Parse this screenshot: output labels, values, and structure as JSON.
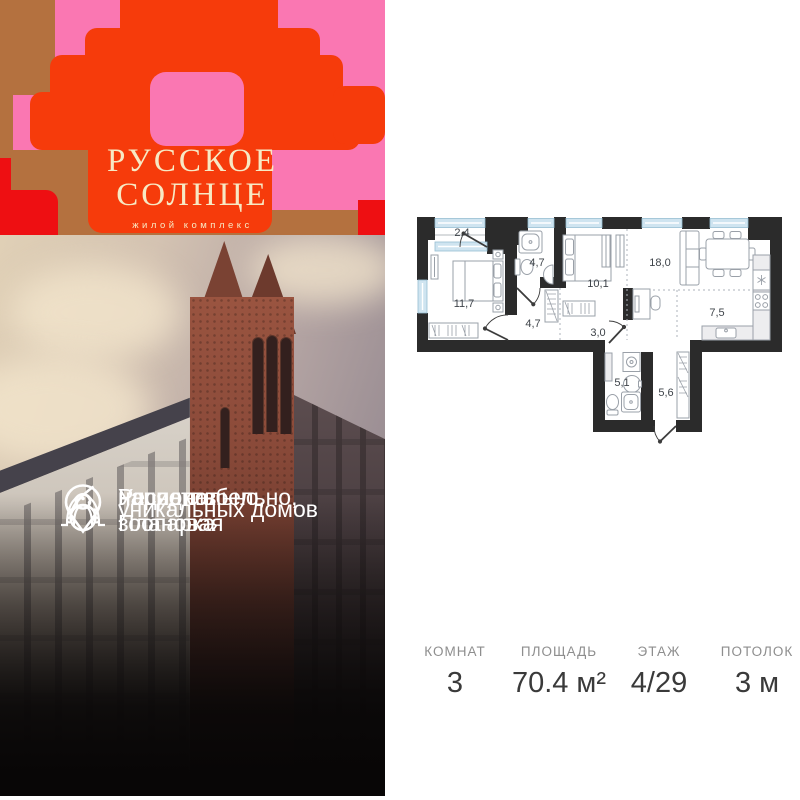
{
  "brand": {
    "name_line1": "РУССКОЕ",
    "name_line2": "СОЛНЦЕ",
    "subtitle": "жилой комплекс"
  },
  "features": [
    {
      "icon": "location-pin-icon",
      "lines": [
        "Ул. Плановая",
        "напротив зоопарка"
      ]
    },
    {
      "icon": "number-6-icon",
      "lines": [
        "уникальных домов"
      ]
    },
    {
      "icon": "kokoshnik-icon",
      "lines": [
        "Респектабельно,",
        "национально,",
        "нарядно"
      ]
    }
  ],
  "floor_plan": {
    "rooms": [
      {
        "name": "balcony",
        "area": "2,4"
      },
      {
        "name": "bathroom-top",
        "area": "4,7"
      },
      {
        "name": "bedroom-2",
        "area": "10,1"
      },
      {
        "name": "living-room",
        "area": "18,0"
      },
      {
        "name": "bedroom-1",
        "area": "11,7"
      },
      {
        "name": "hallway",
        "area": "4,7"
      },
      {
        "name": "corridor",
        "area": "3,0"
      },
      {
        "name": "kitchen",
        "area": "7,5"
      },
      {
        "name": "bathroom-2",
        "area": "5,1"
      },
      {
        "name": "entry-hall",
        "area": "5,6"
      }
    ]
  },
  "stats": [
    {
      "label": "КОМНАТ",
      "value": "3"
    },
    {
      "label": "ПЛОЩАДЬ",
      "value": "70.4 м²"
    },
    {
      "label": "ЭТАЖ",
      "value": "4/29"
    },
    {
      "label": "ПОТОЛОК",
      "value": "3 м"
    }
  ],
  "colors": {
    "accent_red": "#f63b0b",
    "accent_pink": "#fa77b2",
    "accent_brown": "#b4713f",
    "accent_crimson": "#ee0f12",
    "logo_cream": "#f7e9c4",
    "plan_wall": "#2b2b2b",
    "plan_window": "#cfe4f0"
  }
}
